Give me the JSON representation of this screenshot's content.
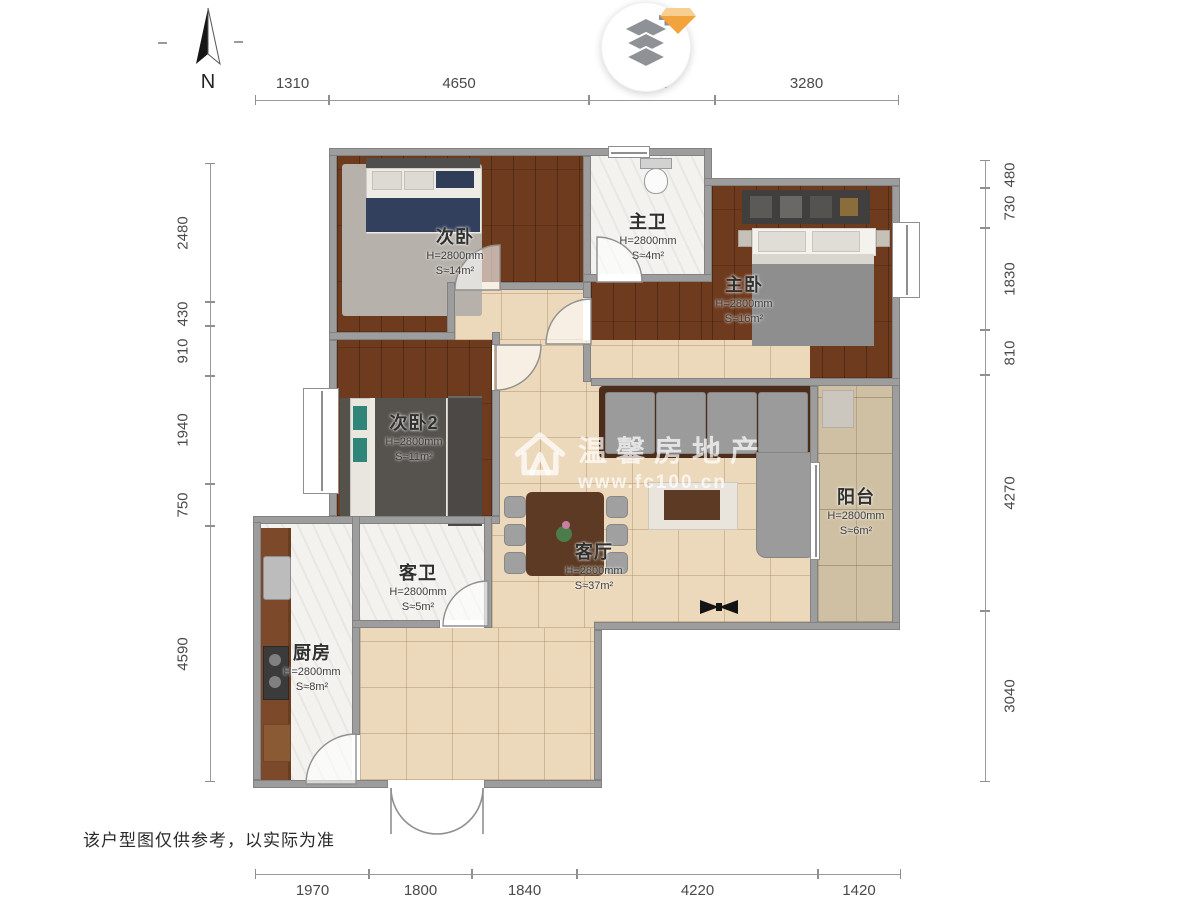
{
  "page": {
    "disclaimer": "该户型图仅供参考，以实际为准"
  },
  "compass": {
    "label": "N"
  },
  "watermark": {
    "brand": "温馨房地产",
    "url": "www.fc100.cn"
  },
  "rooms": {
    "ciwo": {
      "name": "次卧",
      "height": "H=2800mm",
      "area": "S≈14m²"
    },
    "zhuwei": {
      "name": "主卫",
      "height": "H=2800mm",
      "area": "S≈4m²"
    },
    "zhuwo": {
      "name": "主卧",
      "height": "H=2800mm",
      "area": "S≈16m²"
    },
    "ciwo2": {
      "name": "次卧2",
      "height": "H=2800mm",
      "area": "S≈11m²"
    },
    "kewei": {
      "name": "客卫",
      "height": "H=2800mm",
      "area": "S≈5m²"
    },
    "keting": {
      "name": "客厅",
      "height": "H=2800mm",
      "area": "S≈37m²"
    },
    "yangtai": {
      "name": "阳台",
      "height": "H=2800mm",
      "area": "S≈6m²"
    },
    "chufang": {
      "name": "厨房",
      "height": "H=2800mm",
      "area": "S≈8m²"
    }
  },
  "dimensions": {
    "top": [
      "1310",
      "4650",
      "2250",
      "3280"
    ],
    "bottom": [
      "1970",
      "1800",
      "1840",
      "4220",
      "1420"
    ],
    "left": [
      "2480",
      "430",
      "910",
      "1940",
      "750",
      "4590"
    ],
    "right": [
      "480",
      "730",
      "1830",
      "810",
      "4270",
      "3040"
    ]
  },
  "colors": {
    "wood_floor": "#6f3b1e",
    "living_tile": "#ecd8ba",
    "balcony_tile": "#cfc0a3",
    "wall": "#9d9d9d",
    "diamond_accent": "#f2a33c"
  }
}
